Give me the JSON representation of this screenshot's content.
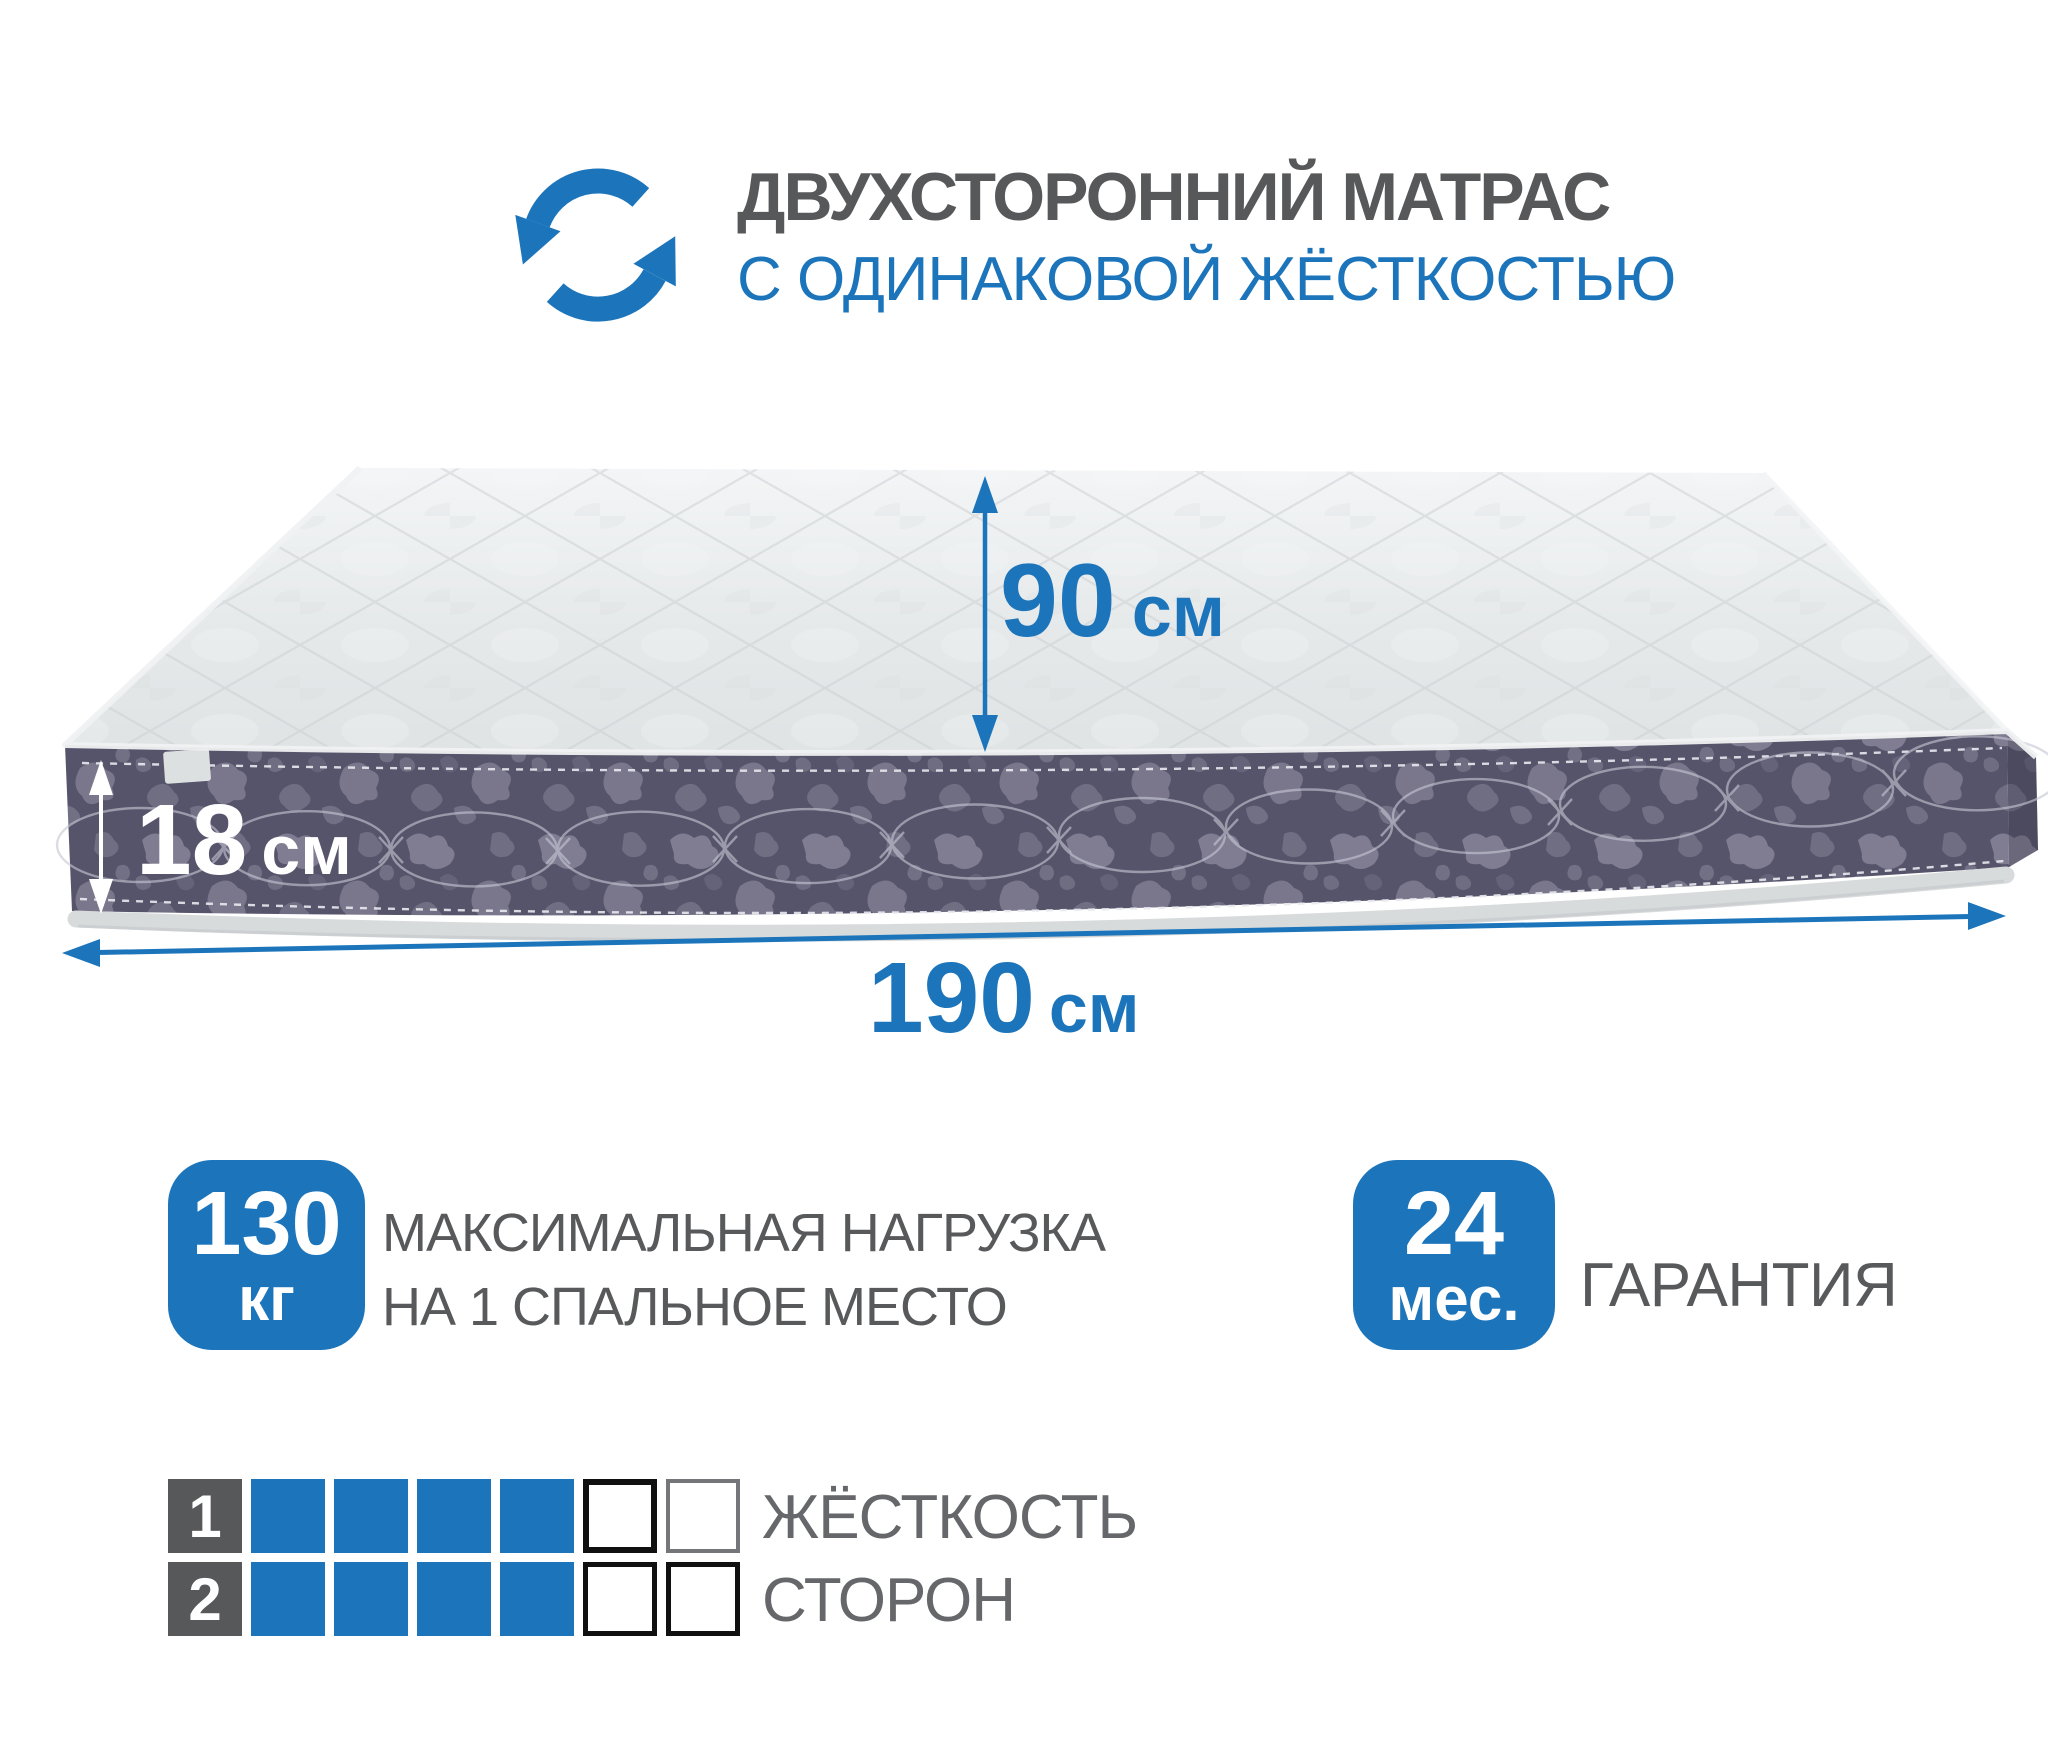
{
  "header": {
    "icon": "rotate-arrows-icon",
    "title": "ДВУХСТОРОННИЙ МАТРАС",
    "subtitle": "С ОДИНАКОВОЙ ЖЁСТКОСТЬЮ"
  },
  "dimensions": {
    "surface_width": {
      "value": "90",
      "unit": "см"
    },
    "thickness": {
      "value": "18",
      "unit": "см"
    },
    "length": {
      "value": "190",
      "unit": "см"
    }
  },
  "badges": {
    "max_load": {
      "value": "130",
      "unit": "кг",
      "label_line1": "МАКСИМАЛЬНАЯ НАГРУЗКА",
      "label_line2": "НА 1 СПАЛЬНОЕ МЕСТО"
    },
    "warranty": {
      "value": "24",
      "unit": "мес.",
      "label": "ГАРАНТИЯ"
    }
  },
  "firmness": {
    "title_line1": "ЖЁСТКОСТЬ",
    "title_line2": "СТОРОН",
    "scale_max": 6,
    "rows": [
      {
        "number": "1",
        "filled": 4,
        "empty_cells": [
          {
            "border_color": "#101010",
            "border_width": 6
          },
          {
            "border_color": "#75767a",
            "border_width": 4
          }
        ]
      },
      {
        "number": "2",
        "filled": 4,
        "empty_cells": [
          {
            "border_color": "#101010",
            "border_width": 5
          },
          {
            "border_color": "#101010",
            "border_width": 5
          }
        ]
      }
    ]
  },
  "colors": {
    "accent_blue": "#1c75bb",
    "heading_gray": "#57585a",
    "text_gray": "#66676a",
    "fabric_side_dark": "#56546a",
    "fabric_side_light": "#8d8b9f",
    "fabric_top": "#e5e8e9",
    "binding_gray": "#d8dbdc",
    "arrow_white": "#ffffff"
  }
}
